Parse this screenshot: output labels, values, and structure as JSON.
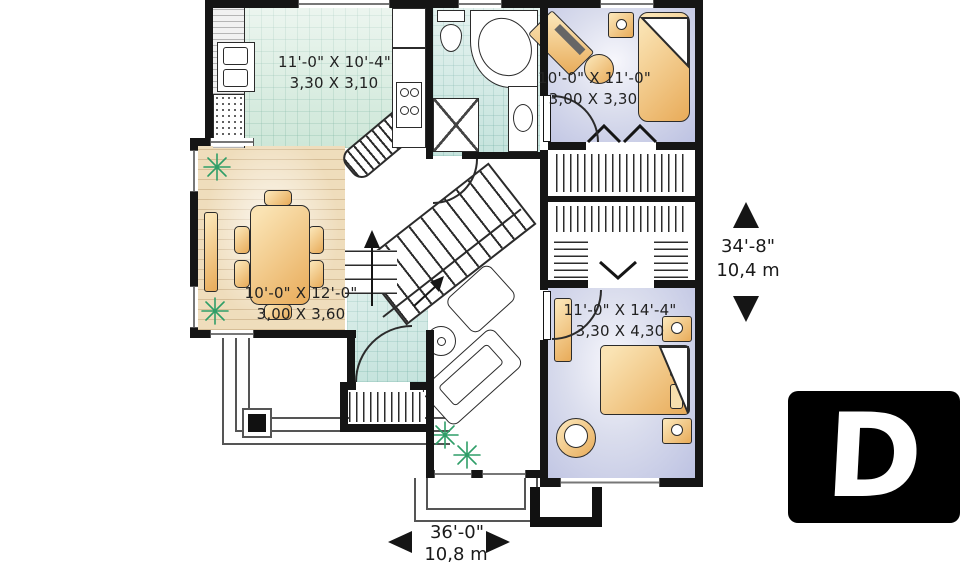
{
  "rooms": {
    "kitchen": {
      "imperial": "11'-0\" X 10'-4\"",
      "metric": "3,30 X 3,10"
    },
    "bedroom_top": {
      "imperial": "10'-0\" X 11'-0\"",
      "metric": "3,00 X 3,30"
    },
    "dining": {
      "imperial": "10'-0\" X 12'-0\"",
      "metric": "3,00 X 3,60"
    },
    "bedroom_bottom": {
      "imperial": "11'-0\" X 14'-4\"",
      "metric": "3,30 X 4,30"
    }
  },
  "dimensions": {
    "overall_depth": {
      "imperial": "34'-8\"",
      "metric": "10,4 m"
    },
    "overall_width": {
      "imperial": "36'-0\"",
      "metric": "10,8 m"
    }
  },
  "logo": {
    "letter": "D"
  },
  "colors": {
    "wall": "#151515",
    "kitchen_tile": "#d9ecdf",
    "bath_tile": "#d2e9e4",
    "bedroom_floor": "#c3c7e5",
    "wood_floor": "#efddbc",
    "furniture": "#f0c98a",
    "plant": "#2f9e68",
    "logo_background": "#000000",
    "logo_letter": "#ffffff"
  }
}
